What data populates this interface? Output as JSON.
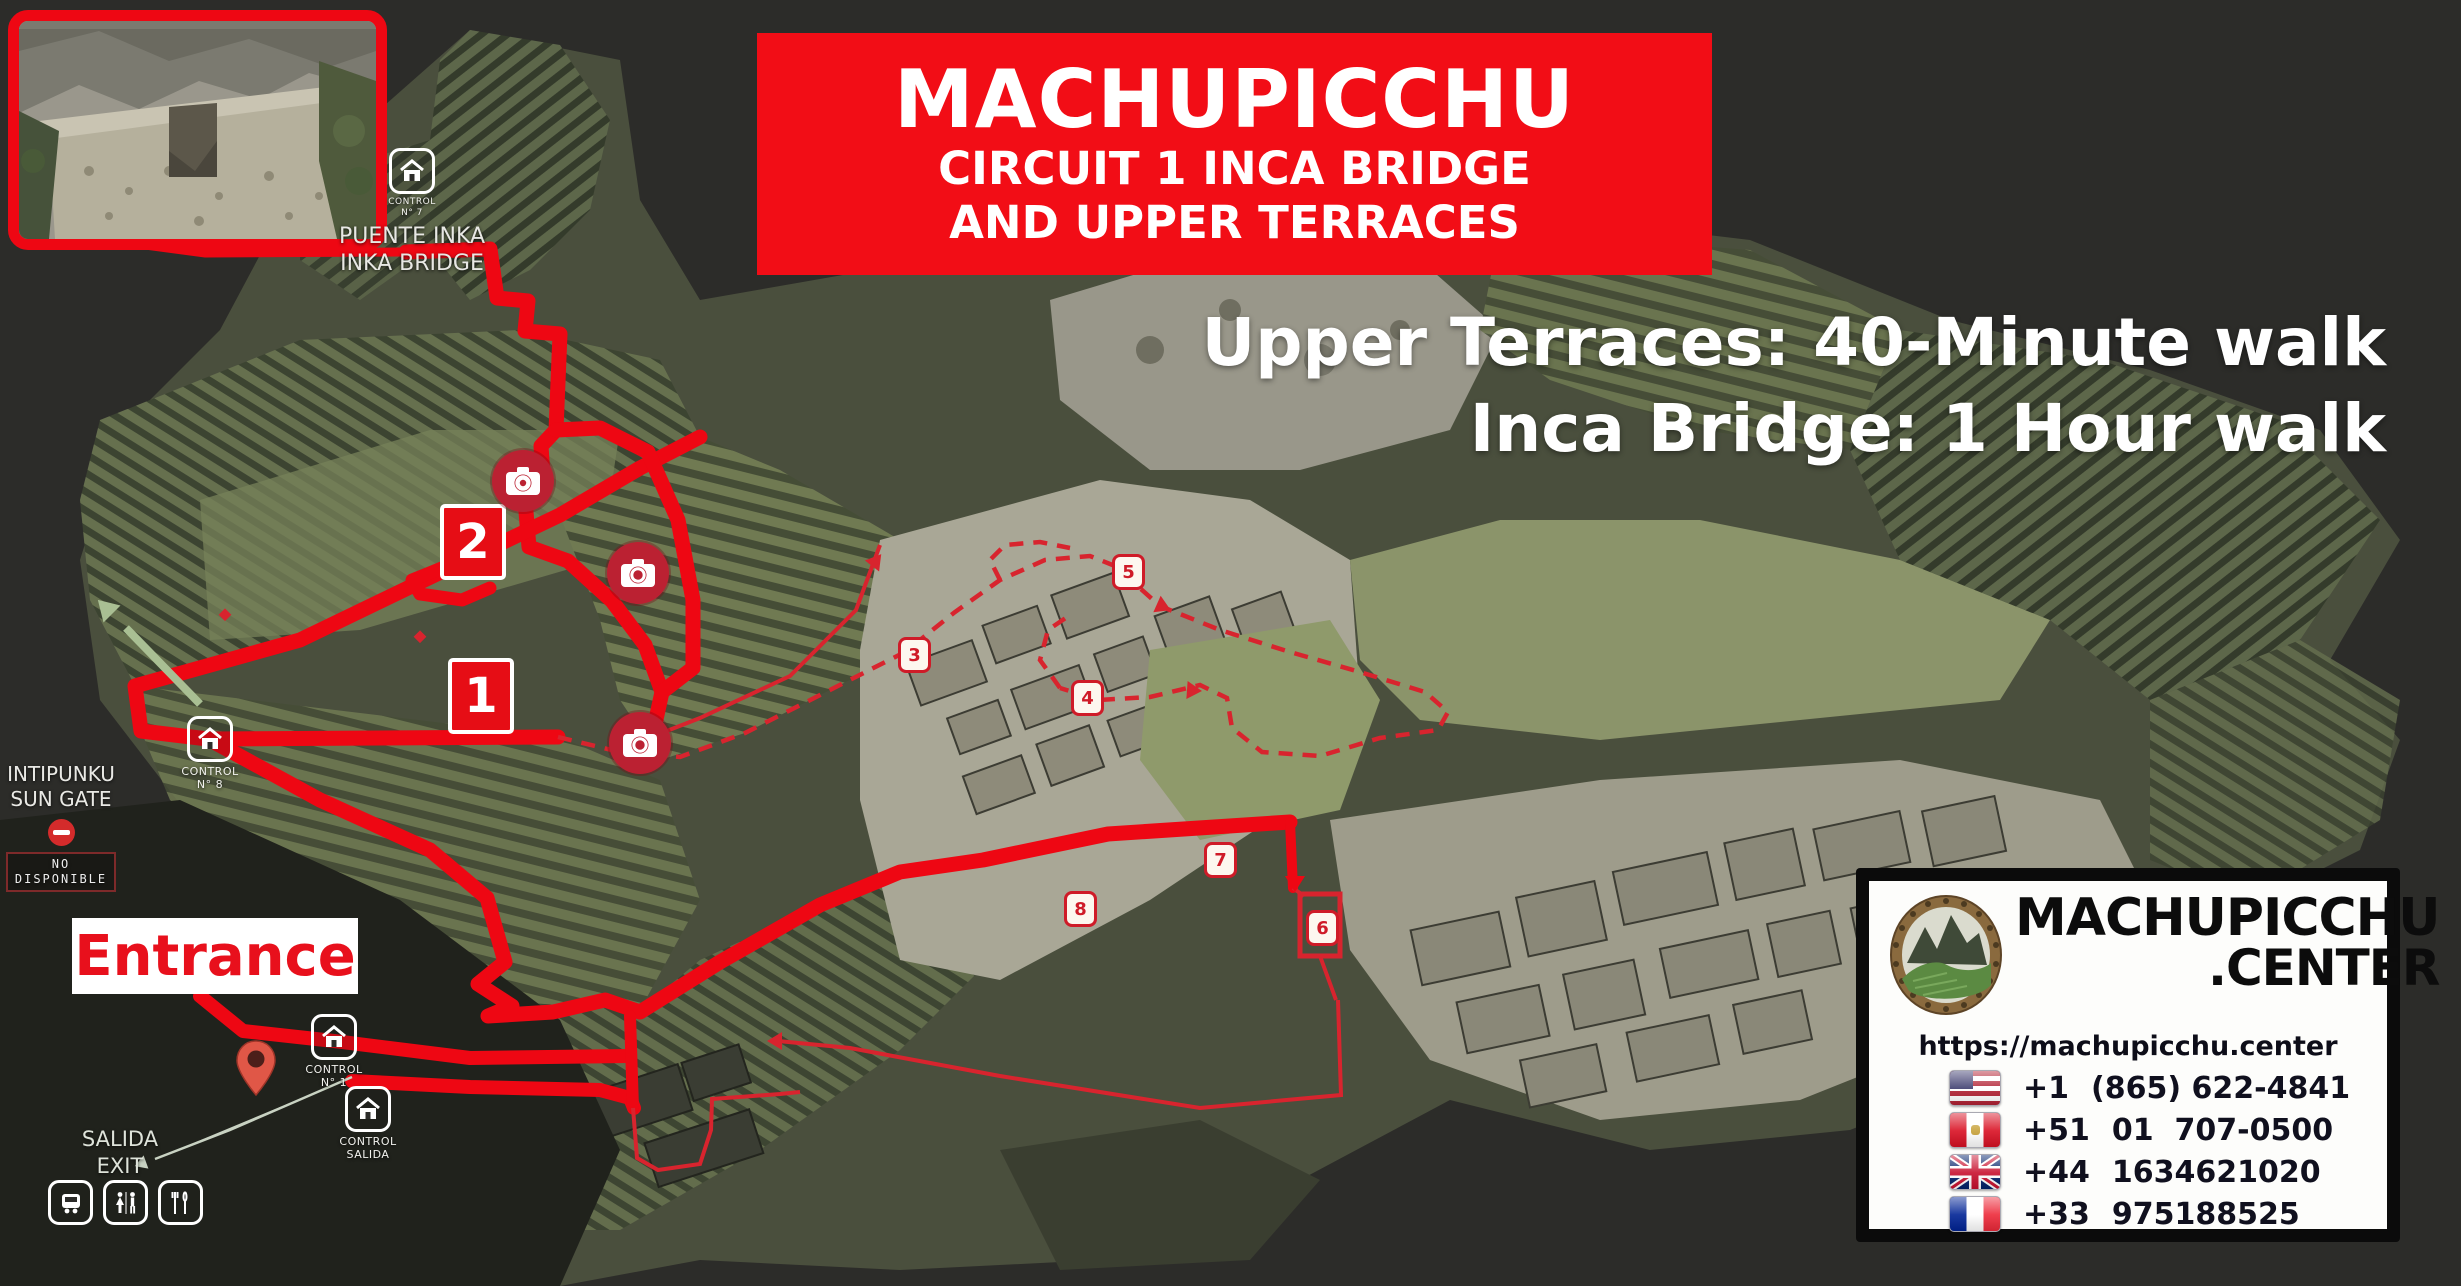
{
  "colors": {
    "background": "#2c2c29",
    "banner_red": "#f20d16",
    "route_red": "#ee0713",
    "thin_route_red": "#d8242e",
    "marker_red": "#cf1b28",
    "camera_red": "#bb2132",
    "entrance_text_red": "#e8101c",
    "text_white": "#ffffff"
  },
  "banner": {
    "line1": "MACHUPICCHU",
    "line2": "CIRCUIT 1 INCA BRIDGE",
    "line3": "AND UPPER TERRACES"
  },
  "subtitle": {
    "line1": "Upper Terraces: 40-Minute walk",
    "line2": "Inca Bridge: 1 Hour walk"
  },
  "inka_bridge": {
    "control_title": "CONTROL",
    "control_no": "N° 7",
    "name_line1": "PUENTE INKA",
    "name_line2": "INKA BRIDGE"
  },
  "sun_gate": {
    "line1": "INTIPUNKU",
    "line2": "SUN GATE",
    "status_badge": "NO DISPONIBLE"
  },
  "entrance": {
    "label": "Entrance"
  },
  "exit": {
    "line1": "SALIDA",
    "line2": "EXIT"
  },
  "route_badges": {
    "stop1": "1",
    "stop2": "2"
  },
  "map_stops": {
    "s3": "3",
    "s4": "4",
    "s5": "5",
    "s6": "6",
    "s7": "7",
    "s8": "8"
  },
  "controls": {
    "c8": {
      "l1": "CONTROL",
      "l2": "N° 8"
    },
    "c1": {
      "l1": "CONTROL",
      "l2": "N° 1"
    },
    "salida": {
      "l1": "CONTROL",
      "l2": "SALIDA"
    }
  },
  "icons": {
    "control_station": "house-icon",
    "photo_spot": "camera-icon",
    "closed": "no-entry-icon",
    "entrance_marker": "map-pin-icon",
    "facilities": [
      "bus-icon",
      "restroom-icon",
      "restaurant-icon"
    ]
  },
  "contact": {
    "brand_line1": "MACHUPICCHU",
    "brand_line2": ".CENTER",
    "url": "https://machupicchu.center",
    "phones": [
      {
        "flag": "usa",
        "prefix": "+1",
        "number": "(865) 622-4841"
      },
      {
        "flag": "peru",
        "prefix": "+51",
        "number": "01  707-0500"
      },
      {
        "flag": "uk",
        "prefix": "+44",
        "number": "1634621020"
      },
      {
        "flag": "france",
        "prefix": "+33",
        "number": "975188525"
      }
    ]
  }
}
